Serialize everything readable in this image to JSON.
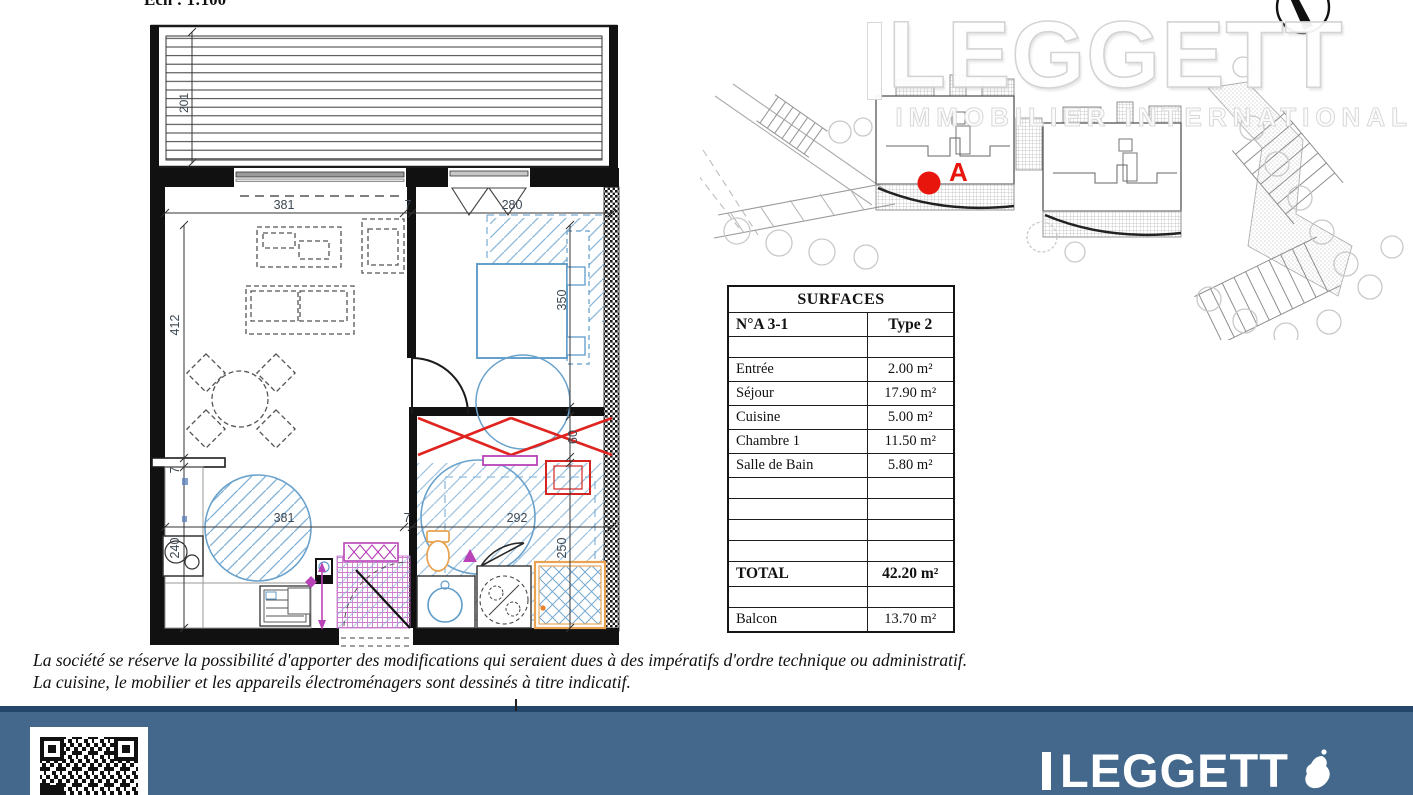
{
  "page": {
    "scale_label": "Ech : 1:100"
  },
  "watermark": {
    "brand": "LEGGETT",
    "tagline": "IMMOBILIER INTERNATIONAL"
  },
  "site_plan": {
    "unit_marker": "A"
  },
  "floor_plan": {
    "dims": {
      "balcony": "201",
      "top_living": "381",
      "top_wall": "7",
      "top_bedroom": "280",
      "left_living": "412",
      "left_wall": "7",
      "left_kitchen": "240",
      "right_bedroom": "350",
      "right_closet": "60",
      "right_bath": "250",
      "bottom_living": "381",
      "bottom_wall": "7",
      "bottom_bath": "292"
    }
  },
  "surfaces_table": {
    "title": "SURFACES",
    "col1_header": "N°A 3-1",
    "col2_header": "Type 2",
    "rows": [
      {
        "label": "Entrée",
        "value": "2.00 m²"
      },
      {
        "label": "Séjour",
        "value": "17.90 m²"
      },
      {
        "label": "Cuisine",
        "value": "5.00 m²"
      },
      {
        "label": "Chambre 1",
        "value": "11.50 m²"
      },
      {
        "label": "Salle de Bain",
        "value": "5.80 m²"
      }
    ],
    "total_label": "TOTAL",
    "total_value": "42.20 m²",
    "balcony_label": "Balcon",
    "balcony_value": "13.70 m²"
  },
  "disclaimer": {
    "line1": "La société se réserve la possibilité d'apporter des modifications qui seraient dues à des impératifs d'ordre technique ou administratif.",
    "line2": "La cuisine, le mobilier et les appareils électroménagers sont dessinés à titre indicatif."
  },
  "footer": {
    "brand": "LEGGETT"
  },
  "colors": {
    "accent_red": "#e8150d",
    "plan_blue": "#5f9cc9",
    "plan_magenta": "#b844b8",
    "plan_orange": "#e9a24f",
    "footer_blue": "#44688c",
    "footer_line": "#24466a"
  }
}
